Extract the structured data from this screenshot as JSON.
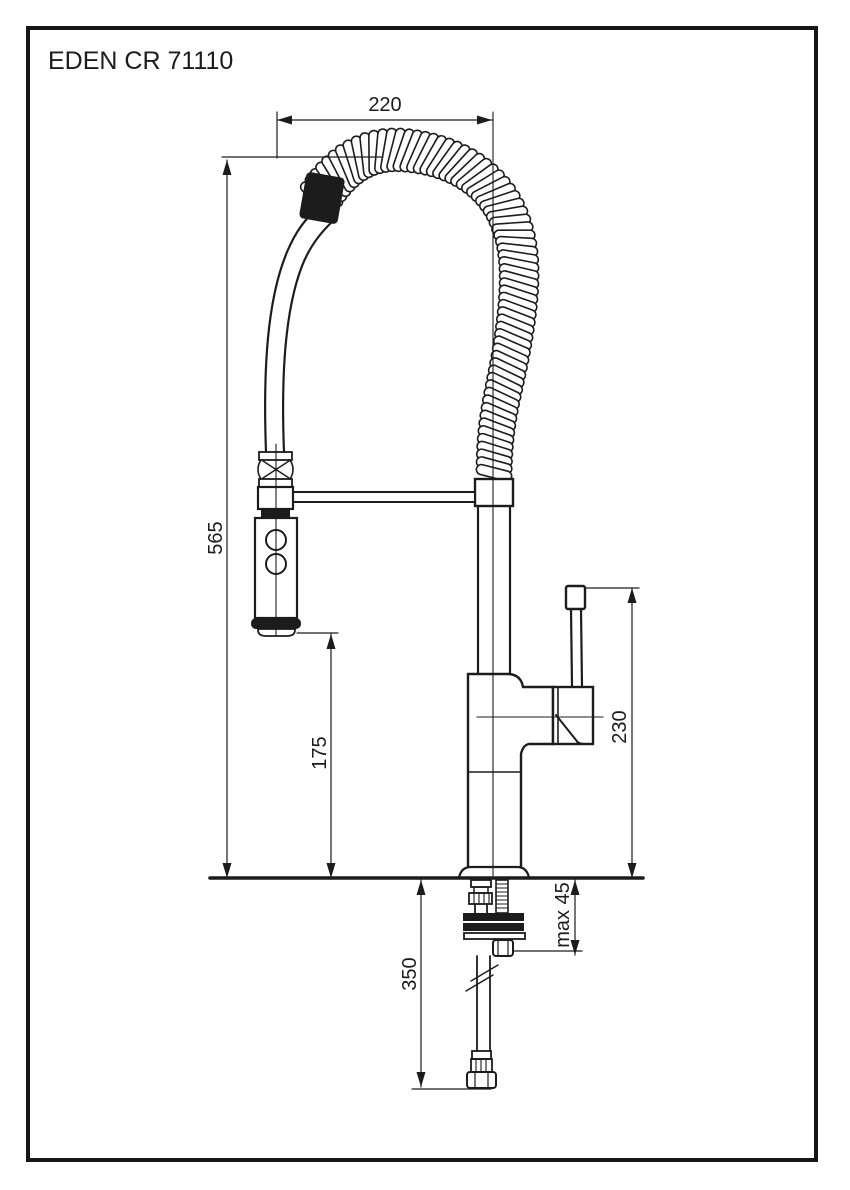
{
  "page": {
    "title": "EDEN CR 71110"
  },
  "diagram": {
    "type": "technical-drawing",
    "subject": "single-lever kitchen faucet with spring pull-out spray head",
    "line_color": "#1c1c1c",
    "background_color": "#ffffff",
    "dimensions": {
      "spout_reach": "220",
      "total_height": "565",
      "spray_outlet_height": "175",
      "handle_height": "230",
      "deck_max_thickness": "max 45",
      "hose_drop": "350"
    }
  }
}
